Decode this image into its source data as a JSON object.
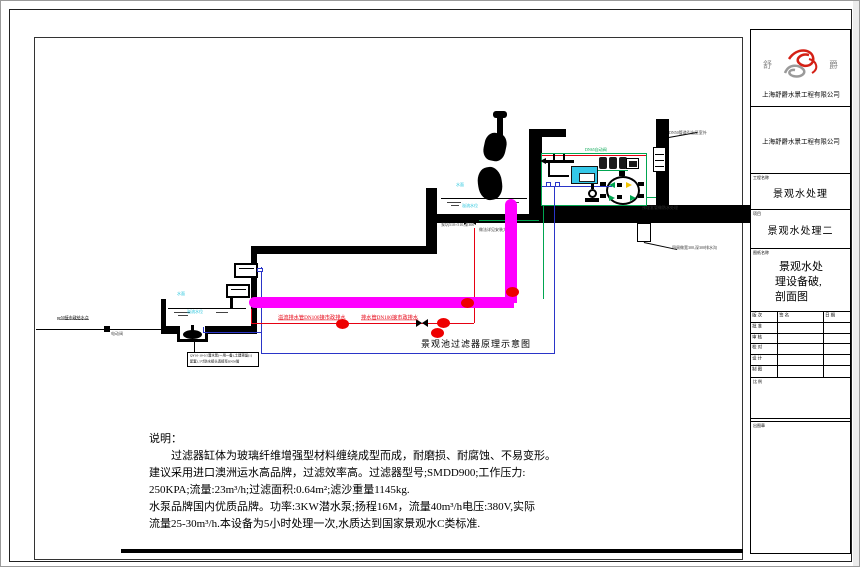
{
  "title_block": {
    "logo_left": "舒",
    "logo_right": "爵",
    "company_top": "上海舒爵水景工程有限公司",
    "company_mid": "上海舒爵水景工程有限公司",
    "project_label": "工程名称",
    "project_name": "景观水处理",
    "item_label": "项目",
    "item_name": "景观水处理二",
    "sheet_label": "图纸名称",
    "sheet_line1": "景观水处",
    "sheet_line2": "理设备破,",
    "sheet_line3": "剖面图",
    "sig_h1": "版 次",
    "sig_h2": "签 名",
    "sig_h3": "日 期",
    "sig_r1": "批 准",
    "sig_r2": "审 核",
    "sig_r3": "校 对",
    "sig_r4": "设 计",
    "sig_r5": "制 图",
    "scale_label": "比 例",
    "stamp_label": "出图章"
  },
  "diagram": {
    "caption": "景观池过滤器原理示意图",
    "labels": {
      "supply": "pe50接市政给水点",
      "electric_valve": "电动阀",
      "overflow_pipe": "溢流排水管DN100接市政排水",
      "drain_pipe": "排水管DN100接市政排水",
      "water_surface_lower": "水面",
      "overflow_level_lower": "溢流水位",
      "water_surface_upper": "水面",
      "overflow_level_upper": "溢流水位",
      "pump_note1": "QY10-10-0.5潜水泵(一用一备),土建预留(1)",
      "pump_note2": "配套1.5寸防水接头连接至DN50管",
      "pit_note1": "泵坑510×510,深300",
      "pit_note2": "做法详见安装大样图",
      "room_note": "DN65自动阀",
      "vent_note": "DN50管道引出至室外",
      "ditch_note": "四周做宽300,深300排水沟",
      "sleeve_note": "预埋套管做防水处理"
    }
  },
  "notes": {
    "heading": "说明：",
    "line1": "　　过滤器缸体为玻璃纤维增强型材料缠绕成型而成，耐磨损、耐腐蚀、不易变形。",
    "line2": "建议采用进口澳洲运水高品牌，过滤效率高。过滤器型号;SMDD900;工作压力:",
    "line3": "250KPA;流量:23m³/h;过滤面积:0.64m²;滤沙重量1145kg.",
    "line4": "水泵品牌国内优质品牌。功率:3KW潜水泵;扬程16M，流量40m³/h电压:380V,实际",
    "line5": "流量25-30m³/h.本设备为5小时处理一次,水质达到国家景观水C类标准."
  },
  "colors": {
    "magenta": "#ff00ff",
    "red": "#e60012",
    "blue": "#2a35c8",
    "green": "#00a550",
    "cyan_label": "#1ec3dc",
    "cabinet_fill": "#35c8e8",
    "yellow": "#f2c400"
  }
}
